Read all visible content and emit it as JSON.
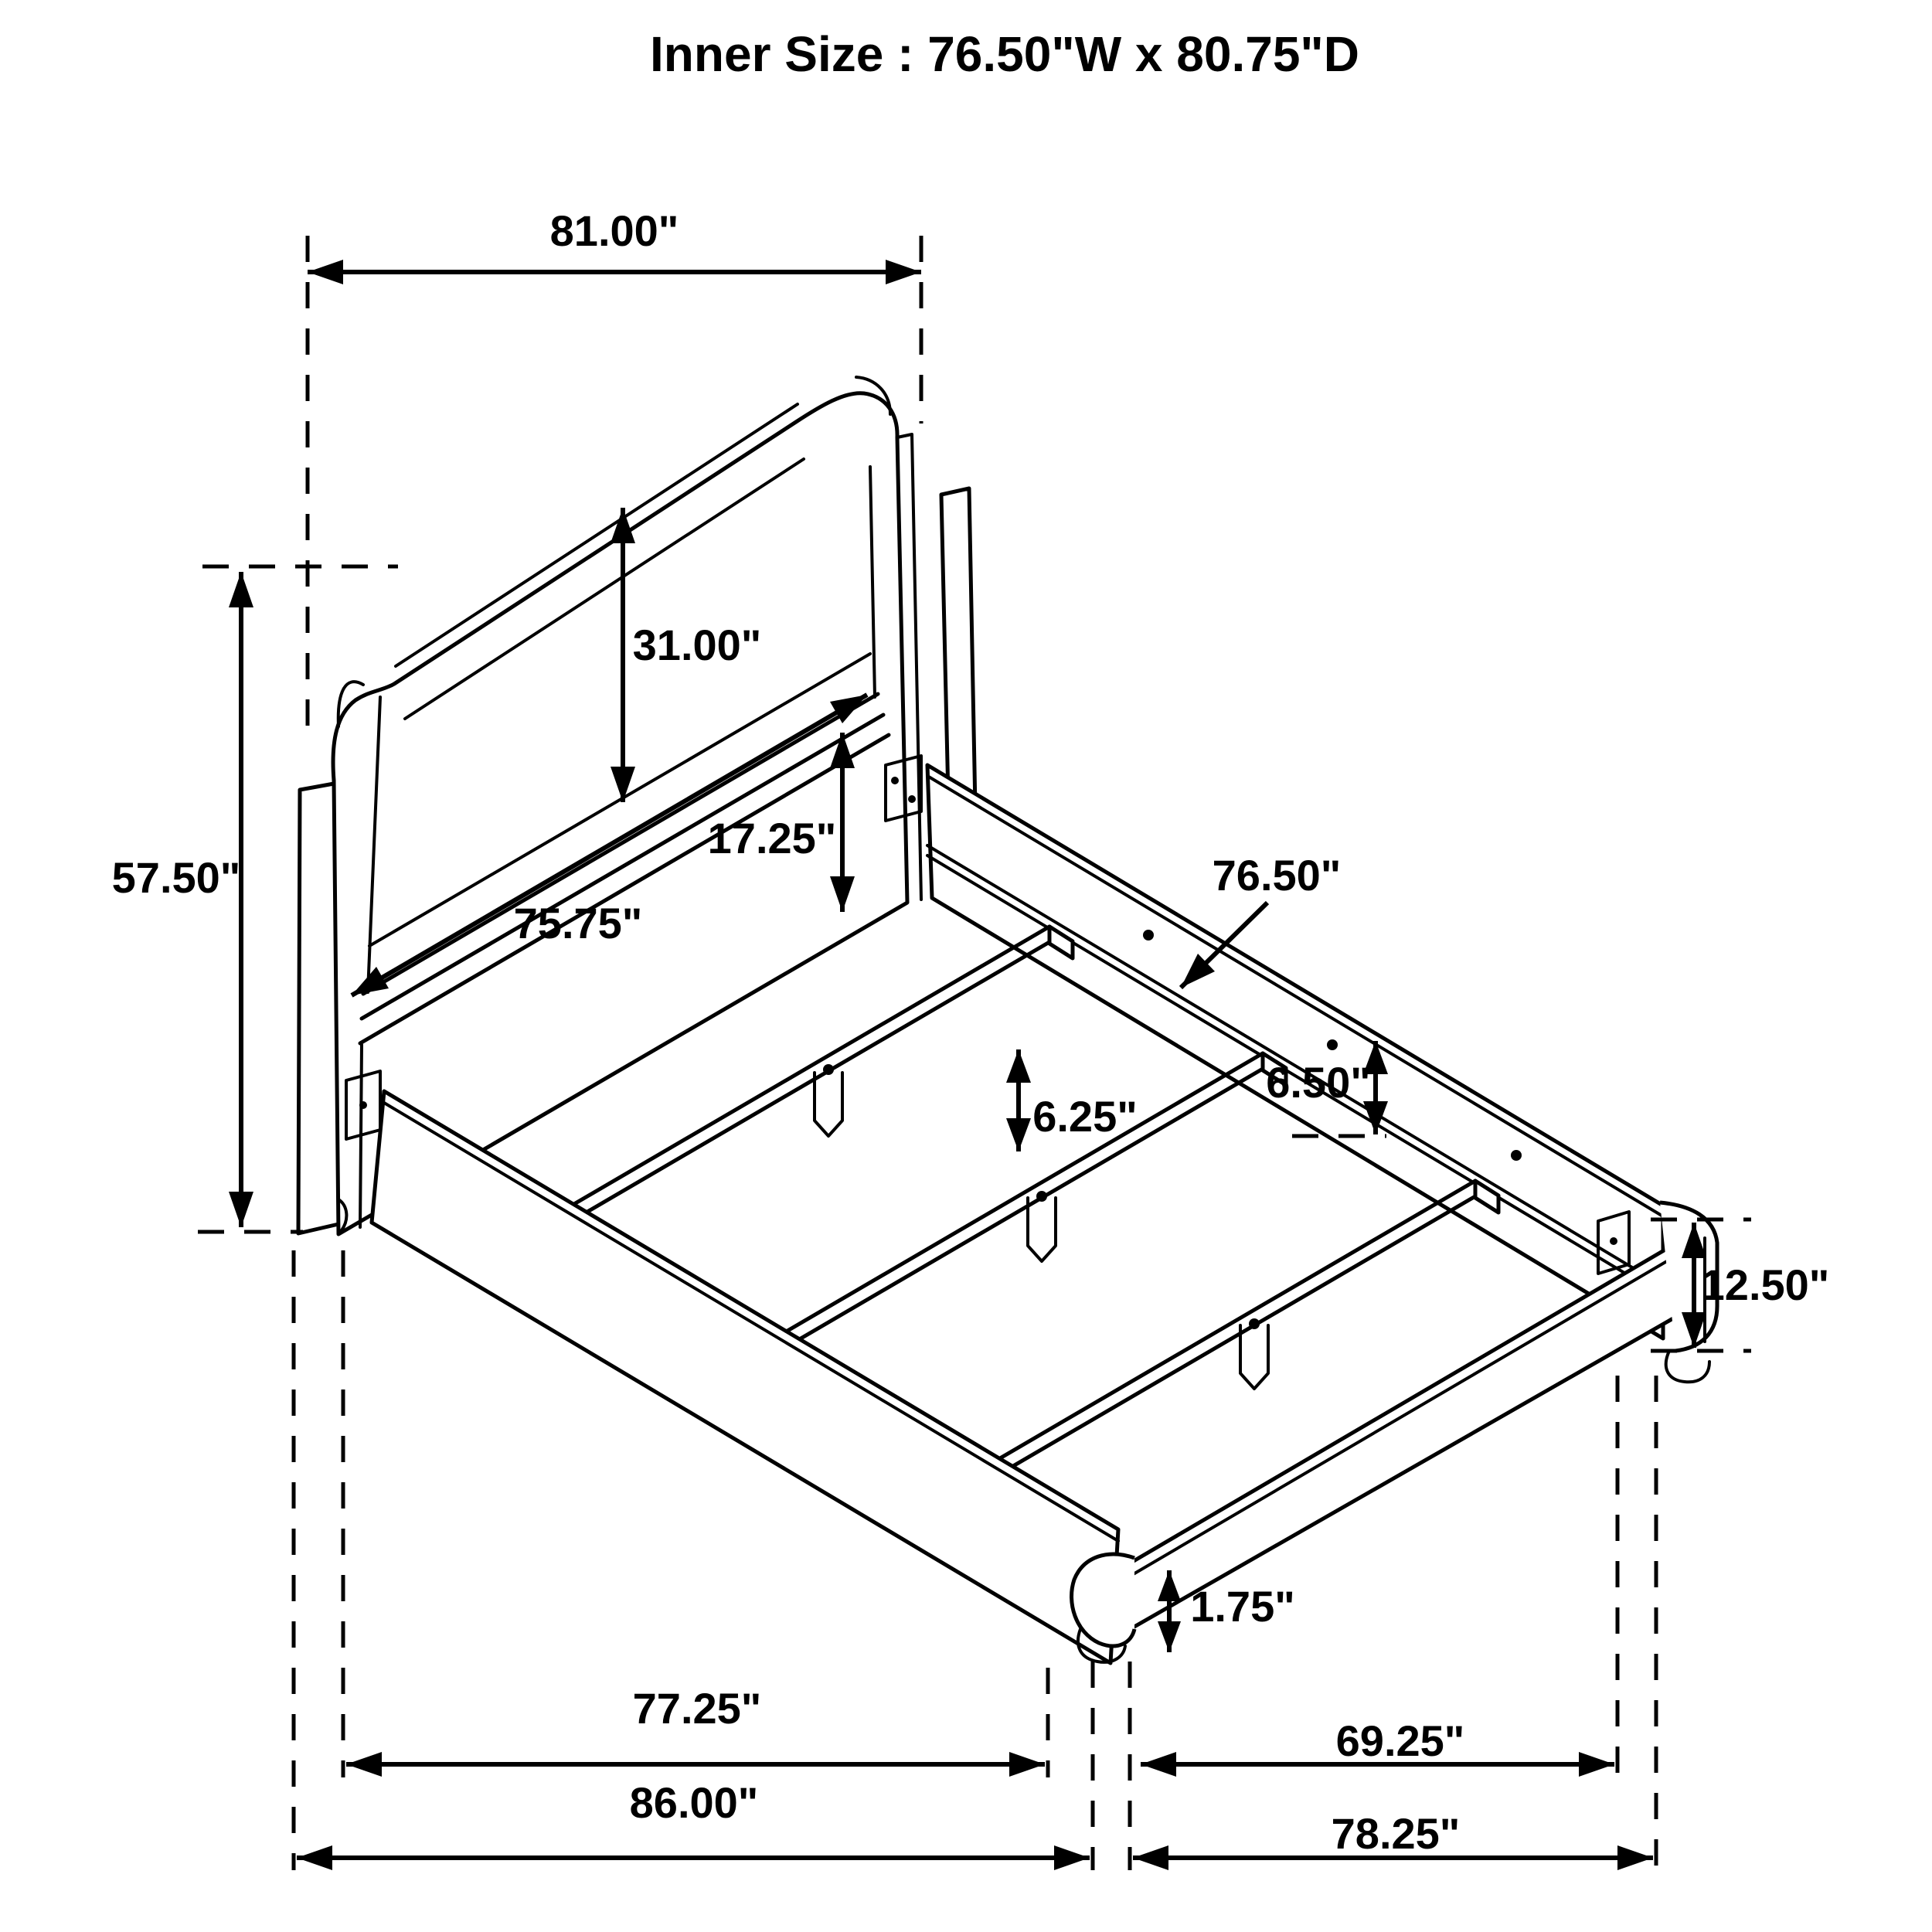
{
  "title": "Inner Size : 76.50\"W x 80.75\"D",
  "diagram": {
    "type": "furniture-dimension-drawing",
    "subject": "bed frame isometric line drawing",
    "units": "inches",
    "dimensions": {
      "inner_width": "76.50\"W",
      "inner_depth": "80.75\"D",
      "headboard_width": "81.00\"",
      "headboard_height": "57.50\"",
      "headboard_panel_height": "31.00\"",
      "floor_to_rail_top": "17.25\"",
      "headboard_rail_length": "75.75\"",
      "slat_length": "76.50\"",
      "rail_top_to_slat_drop": "6.50\"",
      "slat_leg_height": "6.25\"",
      "side_rail_height": "12.50\"",
      "foot_height": "1.75\"",
      "leg_to_leg_length": "77.25\"",
      "overall_length": "86.00\"",
      "footboard_inner_width": "69.25\"",
      "overall_width": "78.25\""
    }
  }
}
